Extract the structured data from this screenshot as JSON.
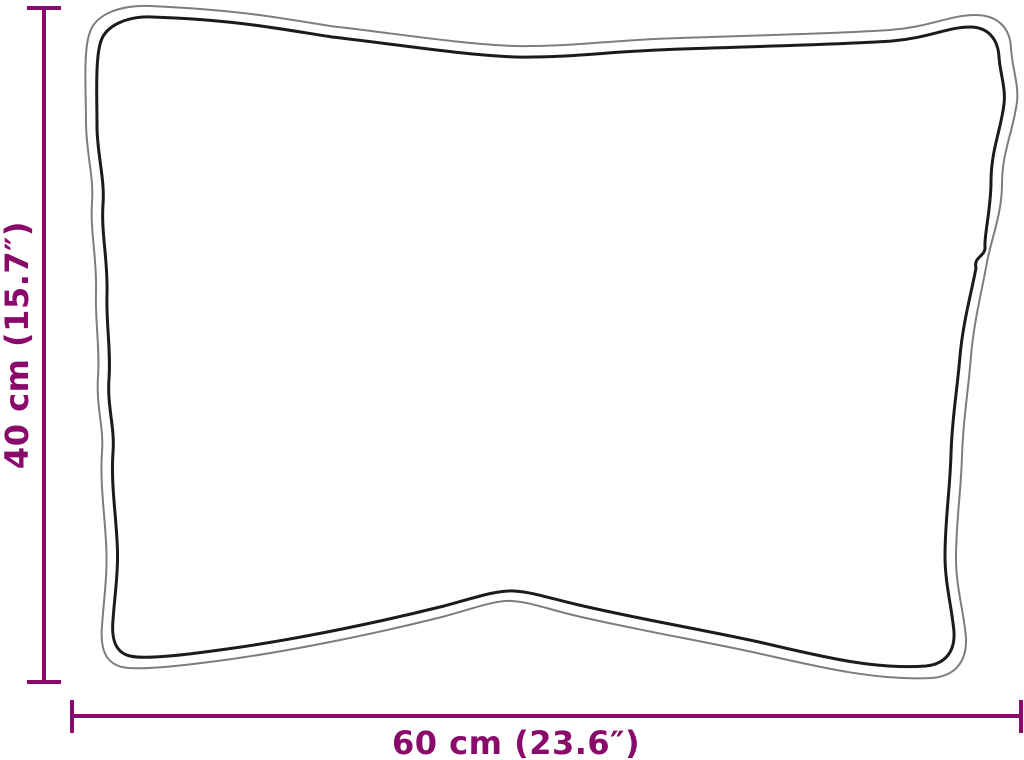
{
  "labels": {
    "height": "40 cm (15.7″)",
    "width": "60 cm (23.6″)"
  },
  "colors": {
    "dimension": "#8A0A6B",
    "outline_inner": "#1b1b1b",
    "outline_outer": "#7d7d7d",
    "background": "#ffffff"
  },
  "icons": {
    "height_dimension": "t-bar-dimension-line-vertical",
    "width_dimension": "t-bar-dimension-line-horizontal"
  }
}
